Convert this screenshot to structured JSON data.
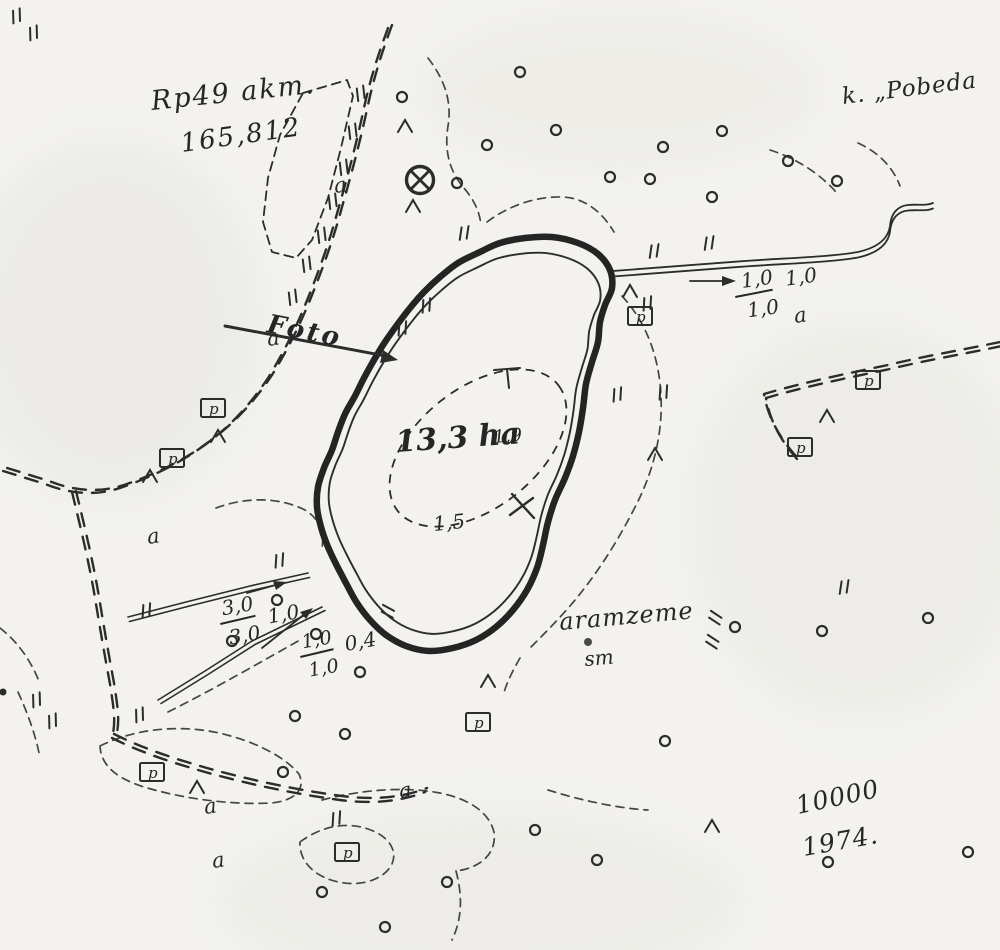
{
  "meta": {
    "ink_color": "#2c2c2c",
    "paper_color": "#f3f2ee",
    "map_type": "scanned hand-drawn lake survey map"
  },
  "labels": {
    "benchmark_line1": "Rp49 akm.",
    "benchmark_line2": "165,812",
    "village": "k. „Pobeda",
    "foto": "Foto",
    "lake_area": "13,3 ha",
    "depth_1": "1,9",
    "depth_2": "1,5",
    "land_use": "aramzeme",
    "land_use_sub": "sm",
    "scale": "10000",
    "year": "1974.",
    "outlet_num": "1,0",
    "outlet_den": "1,0",
    "outlet_side": "1,0",
    "ditch1_num": "3,0",
    "ditch1_den": "3,0",
    "ditch1_side": "1,0",
    "ditch2_num": "1,0",
    "ditch2_den": "1,0",
    "ditch2_side": "0,4",
    "boxed_letter": "p",
    "letter_a": "a"
  },
  "symbols": {
    "circles": [
      [
        520,
        72
      ],
      [
        402,
        97
      ],
      [
        487,
        145
      ],
      [
        556,
        130
      ],
      [
        610,
        177
      ],
      [
        663,
        147
      ],
      [
        722,
        131
      ],
      [
        788,
        161
      ],
      [
        457,
        183
      ],
      [
        650,
        179
      ],
      [
        712,
        197
      ],
      [
        837,
        181
      ],
      [
        277,
        600
      ],
      [
        232,
        641
      ],
      [
        316,
        634
      ],
      [
        360,
        672
      ],
      [
        295,
        716
      ],
      [
        345,
        734
      ],
      [
        283,
        772
      ],
      [
        665,
        741
      ],
      [
        735,
        627
      ],
      [
        822,
        631
      ],
      [
        928,
        618
      ],
      [
        535,
        830
      ],
      [
        597,
        860
      ],
      [
        447,
        882
      ],
      [
        385,
        927
      ],
      [
        322,
        892
      ],
      [
        828,
        862
      ],
      [
        968,
        852
      ]
    ],
    "conifers": [
      [
        405,
        127
      ],
      [
        413,
        207
      ],
      [
        630,
        292
      ],
      [
        655,
        455
      ],
      [
        827,
        417
      ],
      [
        218,
        437
      ],
      [
        150,
        477
      ],
      [
        197,
        788
      ],
      [
        712,
        827
      ],
      [
        488,
        682
      ]
    ],
    "grass": [
      [
        10,
        14,
        -20
      ],
      [
        27,
        31,
        -20
      ],
      [
        354,
        92,
        -25
      ],
      [
        346,
        130,
        -25
      ],
      [
        337,
        166,
        -25
      ],
      [
        326,
        200,
        -25
      ],
      [
        315,
        234,
        -25
      ],
      [
        300,
        263,
        -25
      ],
      [
        286,
        296,
        -25
      ],
      [
        458,
        230,
        -10
      ],
      [
        420,
        303,
        -15
      ],
      [
        396,
        326,
        -15
      ],
      [
        648,
        248,
        -10
      ],
      [
        703,
        240,
        -10
      ],
      [
        641,
        301,
        -15
      ],
      [
        611,
        392,
        -15
      ],
      [
        657,
        390,
        -15
      ],
      [
        133,
        713,
        -20
      ],
      [
        46,
        719,
        -20
      ],
      [
        30,
        698,
        -20
      ],
      [
        330,
        816,
        -15
      ],
      [
        838,
        584,
        -10
      ],
      [
        273,
        558,
        -15
      ],
      [
        140,
        608,
        -15
      ],
      [
        383,
        616,
        -80
      ],
      [
        710,
        622,
        -75
      ],
      [
        707,
        646,
        -75
      ]
    ],
    "boxed_p": [
      [
        213,
        408
      ],
      [
        172,
        458
      ],
      [
        640,
        316
      ],
      [
        868,
        380
      ],
      [
        800,
        447
      ],
      [
        478,
        722
      ],
      [
        152,
        772
      ],
      [
        347,
        852
      ]
    ],
    "letter_a": [
      [
        335,
        193
      ],
      [
        268,
        346
      ],
      [
        795,
        323
      ],
      [
        148,
        544
      ],
      [
        205,
        814
      ],
      [
        400,
        798
      ],
      [
        213,
        868
      ]
    ]
  },
  "geometry": {
    "lake_outer": [
      [
        480,
        252
      ],
      [
        500,
        243
      ],
      [
        525,
        238
      ],
      [
        552,
        237
      ],
      [
        578,
        243
      ],
      [
        598,
        254
      ],
      [
        610,
        270
      ],
      [
        612,
        288
      ],
      [
        605,
        305
      ],
      [
        600,
        322
      ],
      [
        598,
        342
      ],
      [
        592,
        362
      ],
      [
        586,
        384
      ],
      [
        583,
        408
      ],
      [
        579,
        432
      ],
      [
        573,
        456
      ],
      [
        565,
        478
      ],
      [
        555,
        500
      ],
      [
        548,
        522
      ],
      [
        543,
        545
      ],
      [
        537,
        568
      ],
      [
        527,
        590
      ],
      [
        513,
        610
      ],
      [
        496,
        627
      ],
      [
        476,
        640
      ],
      [
        453,
        648
      ],
      [
        429,
        651
      ],
      [
        406,
        646
      ],
      [
        386,
        635
      ],
      [
        370,
        620
      ],
      [
        357,
        603
      ],
      [
        347,
        585
      ],
      [
        337,
        566
      ],
      [
        328,
        547
      ],
      [
        321,
        527
      ],
      [
        317,
        507
      ],
      [
        318,
        487
      ],
      [
        324,
        468
      ],
      [
        332,
        450
      ],
      [
        338,
        432
      ],
      [
        345,
        414
      ],
      [
        355,
        396
      ],
      [
        364,
        378
      ],
      [
        374,
        360
      ],
      [
        385,
        342
      ],
      [
        397,
        325
      ],
      [
        410,
        308
      ],
      [
        424,
        292
      ],
      [
        440,
        277
      ],
      [
        458,
        263
      ]
    ],
    "inner_shrink": 0.08
  }
}
